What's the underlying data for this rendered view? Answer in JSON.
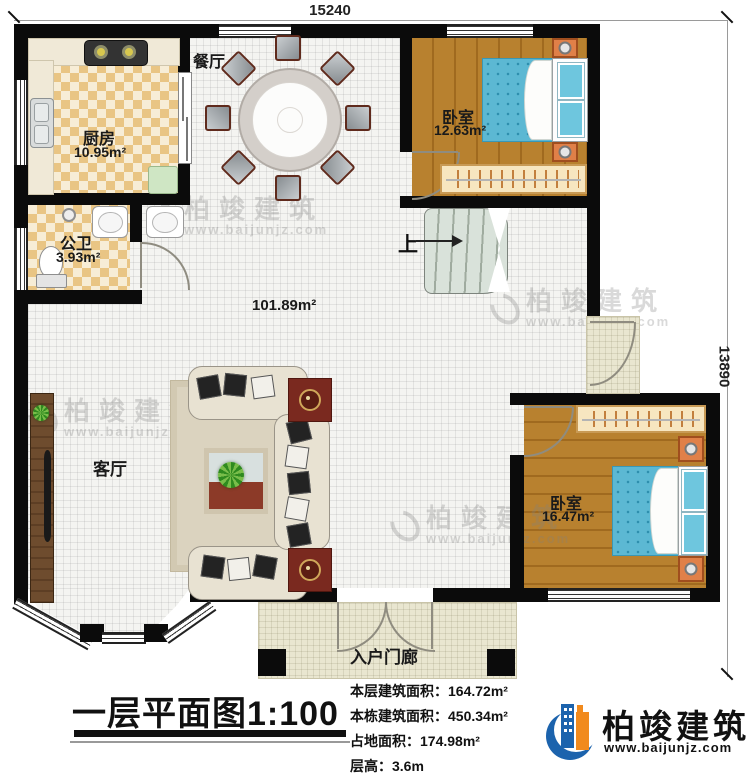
{
  "dimensions": {
    "top": "15240",
    "right": "13890"
  },
  "rooms": {
    "dining": {
      "label": "餐厅"
    },
    "kitchen": {
      "label": "厨房",
      "area": "10.95m²"
    },
    "bathroom": {
      "label": "公卫",
      "area": "3.93m²"
    },
    "bedroom1": {
      "label": "卧室",
      "area": "12.63m²"
    },
    "hall": {
      "area": "101.89m²"
    },
    "living": {
      "label": "客厅"
    },
    "bedroom2": {
      "label": "卧室",
      "area": "16.47m²"
    },
    "porch": {
      "label": "入户门廊"
    }
  },
  "stairs": {
    "up_label": "上"
  },
  "title": {
    "main": "一层平面图",
    "scale": "1:100"
  },
  "info": {
    "floor_area": {
      "label": "本层建筑面积：",
      "value": "164.72m²"
    },
    "building_area": {
      "label": "本栋建筑面积：",
      "value": "450.34m²"
    },
    "footprint_area": {
      "label": "占地面积：",
      "value": "174.98m²"
    },
    "floor_height": {
      "label": "层高：",
      "value": "3.6m"
    }
  },
  "brand": {
    "name": "柏竣建筑",
    "website": "www.baijunjz.com"
  },
  "watermark": {
    "name": "柏竣建筑",
    "website": "www.baijunjz.com"
  },
  "colors": {
    "wall": "#0b0b0b",
    "wood_floor": "#b8812f",
    "tile": "#e9c584",
    "bed": "#5cb8d3",
    "logo_blue": "#1c63ad",
    "logo_orange": "#f18a1d"
  }
}
